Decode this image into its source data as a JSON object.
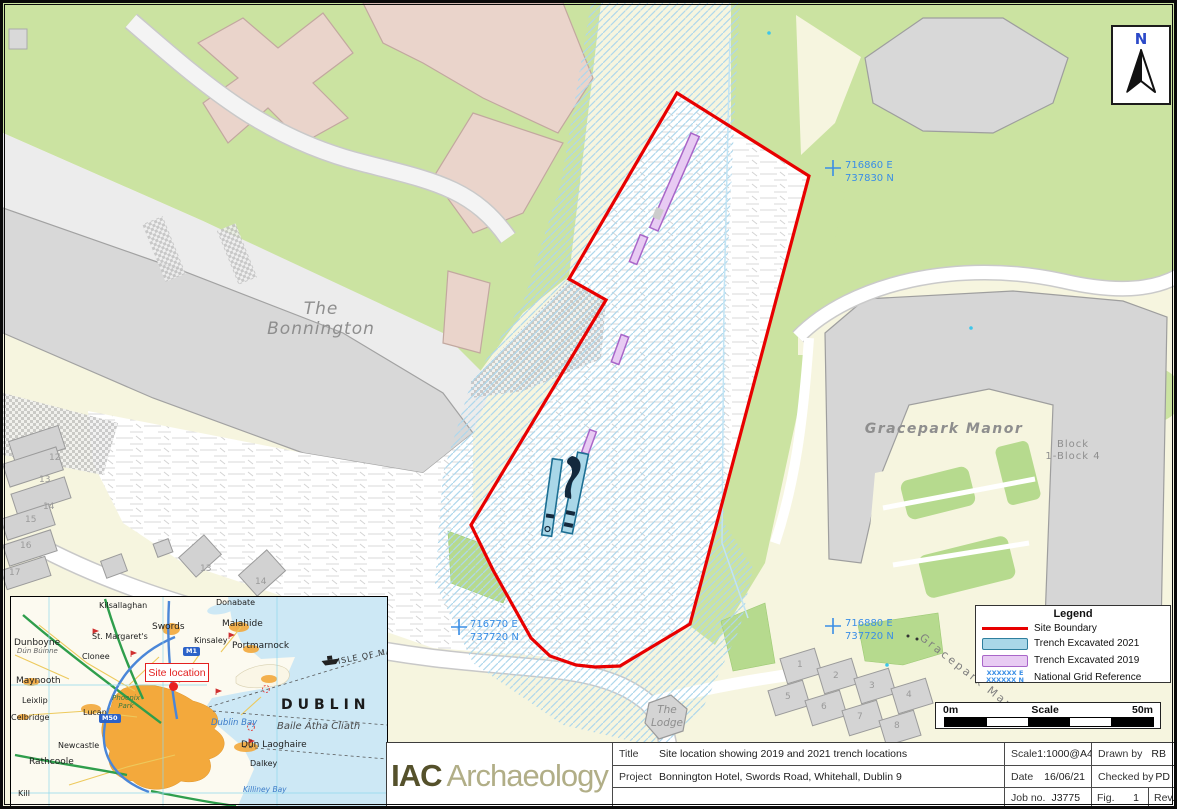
{
  "map": {
    "labels": {
      "bonnington_l1": "The",
      "bonnington_l2": "Bonnington",
      "gracepark_manor": "Gracepark Manor",
      "block_l1": "Block",
      "block_l2": "1-Block 4",
      "lodge_l1": "The",
      "lodge_l2": "Lodge",
      "road_gracepark": "Gracepark Man",
      "north": "N"
    },
    "grid_refs": [
      {
        "e": "716860 E",
        "n": "737830 N"
      },
      {
        "e": "716770 E",
        "n": "737720 N"
      },
      {
        "e": "716880 E",
        "n": "737720 N"
      }
    ],
    "house_numbers": [
      "12",
      "13",
      "14",
      "15",
      "16",
      "17",
      "13",
      "14"
    ],
    "plot_numbers": [
      "1",
      "2",
      "3",
      "4",
      "5",
      "6",
      "7",
      "8"
    ]
  },
  "legend": {
    "title": "Legend",
    "items": [
      {
        "label": "Site Boundary"
      },
      {
        "label": "Trench Excavated 2021"
      },
      {
        "label": "Trench Excavated 2019"
      },
      {
        "label": "National Grid Reference"
      }
    ],
    "grid_ref_sample_e": "XXXXXX E",
    "grid_ref_sample_n": "XXXXXX N"
  },
  "scalebar": {
    "start": "0m",
    "title": "Scale",
    "end": "50m"
  },
  "logo": {
    "primary": "IAC",
    "secondary": "Archaeology"
  },
  "titleblock": {
    "title_label": "Title",
    "title_value": "Site location showing 2019 and 2021 trench locations",
    "project_label": "Project",
    "project_value": "Bonnington Hotel, Swords Road, Whitehall, Dublin 9",
    "scale_label": "Scale",
    "scale_value": "1:1000@A4",
    "date_label": "Date",
    "date_value": "16/06/21",
    "job_label": "Job no.",
    "job_value": "J3775",
    "drawn_label": "Drawn by",
    "drawn_value": "RB",
    "checked_label": "Checked by",
    "checked_value": "PD",
    "fig_label": "Fig.",
    "fig_value": "1",
    "rev_label": "Rev.",
    "rev_value": "-"
  },
  "inset": {
    "site_marker": "Site location",
    "city": "DUBLIN",
    "city_irish": "Baile Átha Cliath",
    "dublin_bay": "Dublin Bay",
    "killiney_bay": "Killiney Bay",
    "isle_of_man": "ISLE OF MAN",
    "phoenix_park": "Phoenix Park",
    "dunboyne_irish": "Dún Búinne",
    "m50": "M50",
    "m1": "M1",
    "towns": [
      "Donabate",
      "Kilsallaghan",
      "Swords",
      "Malahide",
      "St. Margaret's",
      "Kinsaley",
      "Portmarnock",
      "Dunboyne",
      "Clonee",
      "Maynooth",
      "Leixlip",
      "Lucan",
      "Newcastle",
      "Rathcoole",
      "Kill",
      "Dún Laoghaire",
      "Dalkey",
      "Celbridge"
    ]
  },
  "colors": {
    "site_boundary_red": "#e80000",
    "trench_2021_fill": "#a9d7e8",
    "trench_2021_stroke": "#2e7f9e",
    "trench_2019_fill": "#e8cbf3",
    "trench_2019_stroke": "#a966c9",
    "grid_ref_blue": "#3a8ee6",
    "grass_green": "#cbe3a1",
    "building_pink": "#ead4cb",
    "building_grey": "#d8d8d8",
    "logo_primary": "#55512b",
    "logo_secondary": "#b1ae87"
  }
}
